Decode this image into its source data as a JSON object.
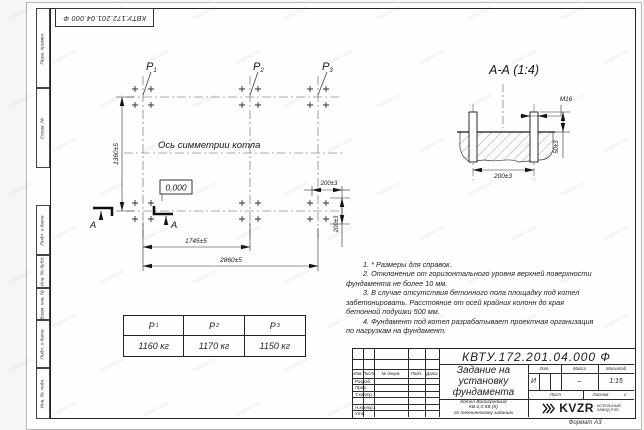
{
  "watermark": "kotel-kv.kz",
  "doc_number": "КВТУ.172.201.04.000  Ф",
  "margin_labels": [
    "Перв. примен.",
    "Справ. №",
    "Подп. и дата",
    "Инв. № дубл.",
    "Взам. инв. №",
    "Подп. и дата",
    "Инв. № подл."
  ],
  "plan": {
    "points": [
      {
        "label": "P",
        "sub": "1"
      },
      {
        "label": "P",
        "sub": "2"
      },
      {
        "label": "P",
        "sub": "3"
      }
    ],
    "axis_label": "Ось симметрии котла",
    "elevation": "0,000",
    "section_letter": "А",
    "dims": {
      "height": "1360±5",
      "mid_span": "1745±5",
      "total_span": "2860±5",
      "cluster_h": "200±3",
      "cluster_v": "200±3"
    }
  },
  "section": {
    "title": "А-А (1:4)",
    "dims": {
      "thread": "М16",
      "protrusion": "50±3",
      "spacing": "200±3"
    }
  },
  "load_table": {
    "headers": [
      {
        "label": "P",
        "sub": "1"
      },
      {
        "label": "P",
        "sub": "2"
      },
      {
        "label": "P",
        "sub": "3"
      }
    ],
    "values": [
      "1160 кг",
      "1170 кг",
      "1150 кг"
    ]
  },
  "notes": [
    "1. * Размеры для справок.",
    "2. Отклонение от горизонтального уровня верхней поверхности фундамента не более 10 мм.",
    "3. В случае отсутствия бетонного пола площадку под котел забетонировать. Расстояние от осей крайних колонн до края бетонной подушки 500 мм.",
    "4. Фундамент под котел разрабатывает проектная организация по нагрузкам на фундамент."
  ],
  "title_block": {
    "title_lines": [
      "Задание на",
      "установку",
      "фундамента"
    ],
    "product_lines": [
      "Котел Водогрейный",
      "КВ-2,0 КБ (К)",
      "по техническому заданию"
    ],
    "rev_headers": [
      "Изм.",
      "Лист",
      "№ докум.",
      "Подп.",
      "Дата"
    ],
    "row_labels": [
      "Разраб.",
      "Пров.",
      "Т.контр.",
      "Н.контр.",
      "Утв."
    ],
    "lit_header": "Лит.",
    "mass_header": "Масса",
    "scale_header": "Масштаб",
    "lit_value": "И",
    "mass_value": "–",
    "scale_value": "1:15",
    "sheet_label": "Лист",
    "sheets_label": "Листов",
    "sheets_value": "1",
    "logo_text": "KVZR",
    "logo_caption": [
      "КОТЕЛЬНЫЙ",
      "ЗАВОД РЭП"
    ],
    "format_label": "Формат А3"
  }
}
